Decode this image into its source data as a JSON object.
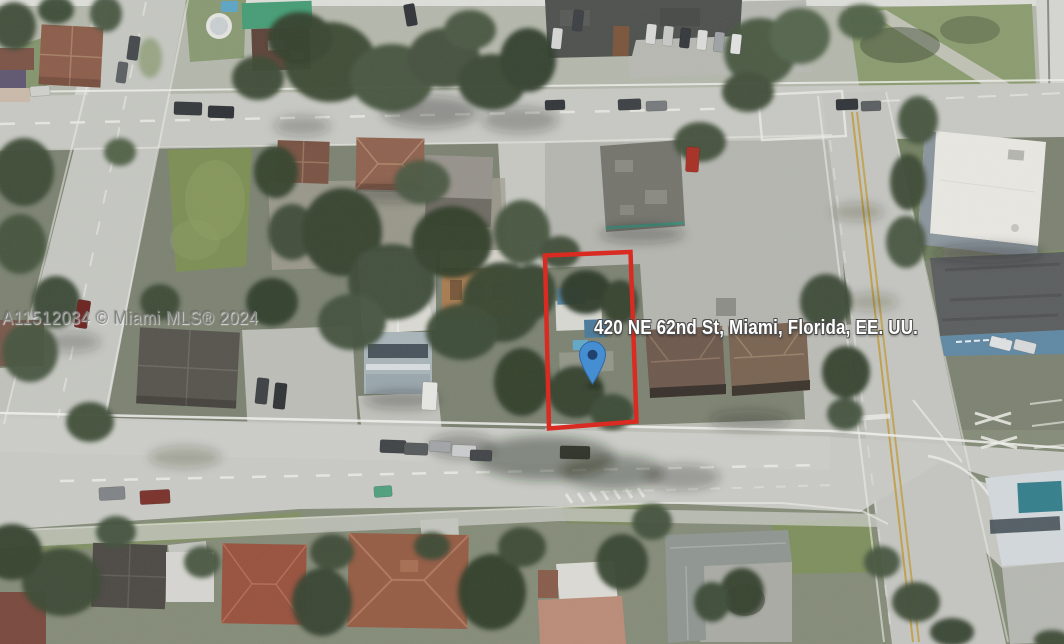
{
  "photo": {
    "type": "satellite-aerial-photo",
    "address_label": "420 NE 62nd St, Miami, Florida, EE. UU.",
    "watermark": "A11512034 © Miami MLS® 2024",
    "colors": {
      "property_boundary": "#e3261b",
      "pin_fill": "#3e8ed7",
      "pin_center": "#1d3f70",
      "road": "#c7c8c3",
      "lawn": "#7b8f4f",
      "tree_canopy": "#3a4933"
    }
  }
}
